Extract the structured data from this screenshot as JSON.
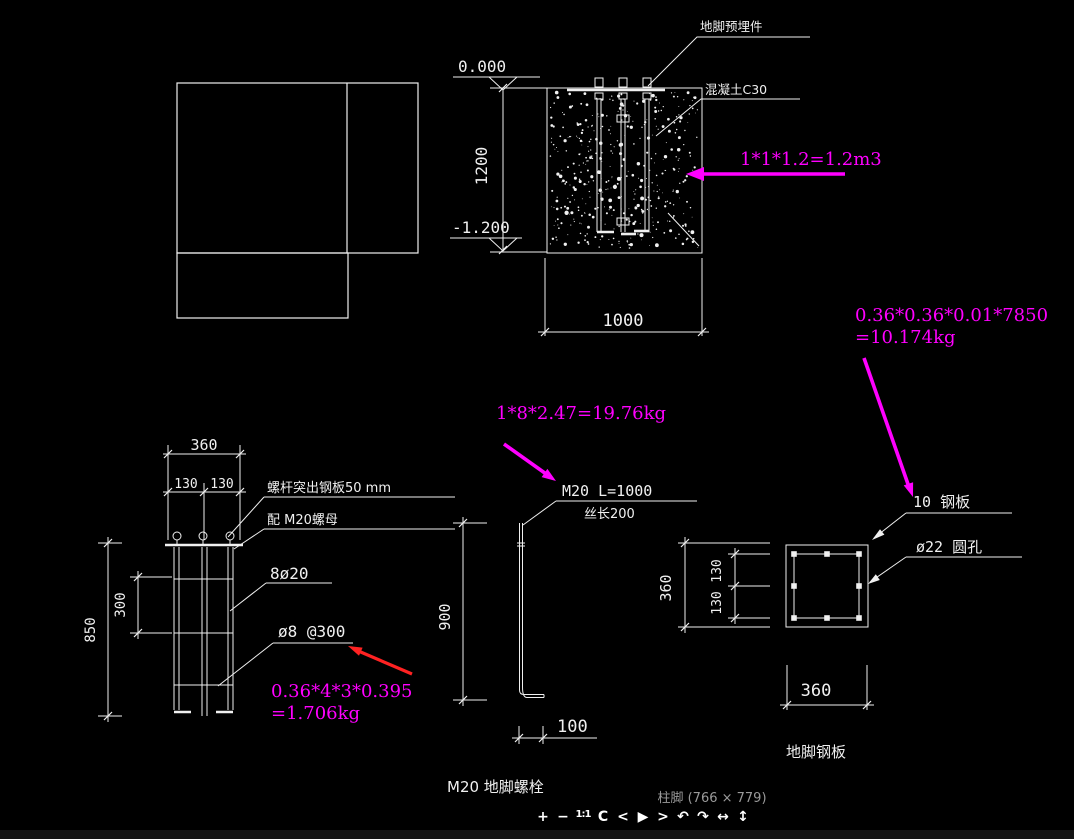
{
  "viewer": {
    "caption": "柱脚 (766 × 779)",
    "toolbar": [
      {
        "name": "zoom-in",
        "glyph": "+"
      },
      {
        "name": "zoom-out",
        "glyph": "−"
      },
      {
        "name": "one-to-one",
        "glyph": "1:1"
      },
      {
        "name": "reset",
        "glyph": "C"
      },
      {
        "name": "prev",
        "glyph": "<"
      },
      {
        "name": "play",
        "glyph": "▶"
      },
      {
        "name": "next",
        "glyph": ">"
      },
      {
        "name": "rotate-left",
        "glyph": "↶"
      },
      {
        "name": "rotate-right",
        "glyph": "↷"
      },
      {
        "name": "flip-horizontal",
        "glyph": "↔"
      },
      {
        "name": "flip-vertical",
        "glyph": "↕"
      }
    ]
  },
  "drawing": {
    "section": {
      "labels": {
        "embed_part": "地脚预埋件",
        "concrete": "混凝土C30"
      },
      "dims": {
        "level_top": "0.000",
        "level_bottom": "-1.200",
        "depth": "1200",
        "width": "1000"
      }
    },
    "cage": {
      "dims": {
        "width": "360",
        "left": "130",
        "right": "130",
        "pitch": "300",
        "height": "850"
      },
      "labels": {
        "protrude": "螺杆突出钢板50 mm",
        "nut": "配 M20螺母",
        "main_bars": "8ø20",
        "stirrups": "ø8 @300"
      }
    },
    "bolt": {
      "dims": {
        "length": "900",
        "hook": "100"
      },
      "labels": {
        "spec": "M20 L=1000",
        "thread": "丝长200",
        "caption": "M20 地脚螺栓"
      }
    },
    "plate": {
      "dims": {
        "height": "360",
        "seg_top": "130",
        "seg_bottom": "130",
        "width": "360"
      },
      "labels": {
        "thickness": "10 钢板",
        "holes": "ø22 圆孔",
        "caption": "地脚钢板"
      }
    },
    "calcs": {
      "concrete_volume": "1*1*1.2=1.2m3",
      "plate_weight_1": "0.36*0.36*0.01*7850",
      "plate_weight_2": "=10.174kg",
      "bolts_weight": "1*8*2.47=19.76kg",
      "stirrup_weight_1": "0.36*4*3*0.395",
      "stirrup_weight_2": "=1.706kg"
    },
    "colors": {
      "line": "#f0f0f0",
      "annotation": "#ff00ff",
      "red_arrow": "#ff2222",
      "caption_gray": "#9a9a9a",
      "toolbar_icon": "#ffffff"
    }
  }
}
